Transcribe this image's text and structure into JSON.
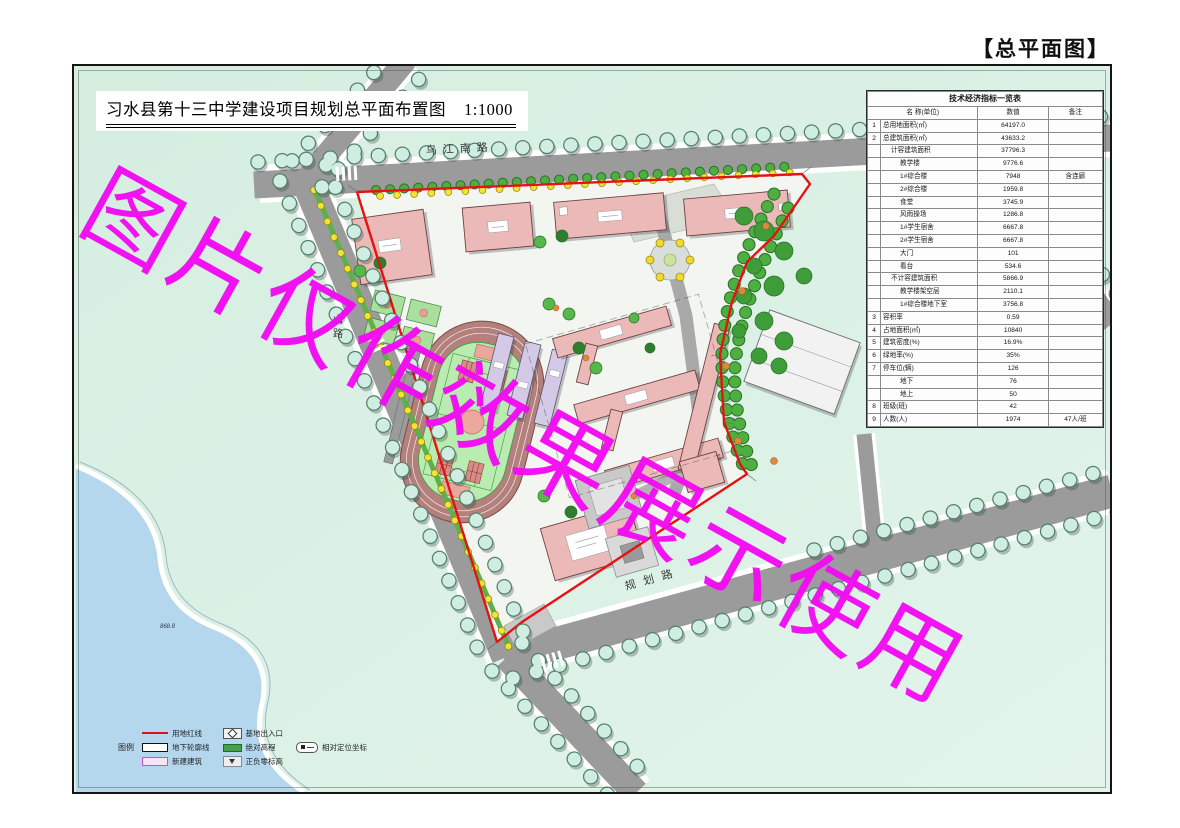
{
  "page_title": "【总平面图】",
  "drawing": {
    "title": "习水县第十三中学建设项目规划总平面布置图",
    "scale": "1:1000"
  },
  "watermark": "图片仅作效果展示使用",
  "roads": {
    "top": "乌江南路",
    "left": "山路",
    "bottom": "规划路"
  },
  "lake_label": "868.8",
  "indicator_table": {
    "title": "技术经济指标一览表",
    "headers": {
      "name": "名 称(单位)",
      "value": "数值",
      "remark": "备注"
    },
    "rows": [
      {
        "no": "1",
        "name": "总用地面积(㎡)",
        "indent": 0,
        "value": "64197.0",
        "remark": ""
      },
      {
        "no": "2",
        "name": "总建筑面积(㎡)",
        "indent": 0,
        "value": "43633.2",
        "remark": ""
      },
      {
        "no": "",
        "name": "计容建筑面积",
        "indent": 1,
        "value": "37796.3",
        "remark": ""
      },
      {
        "no": "",
        "name": "教学楼",
        "indent": 2,
        "value": "9776.6",
        "remark": ""
      },
      {
        "no": "",
        "name": "1#综合楼",
        "indent": 2,
        "value": "7948",
        "remark": "含连廊"
      },
      {
        "no": "",
        "name": "2#综合楼",
        "indent": 2,
        "value": "1959.8",
        "remark": ""
      },
      {
        "no": "",
        "name": "食堂",
        "indent": 2,
        "value": "3745.9",
        "remark": ""
      },
      {
        "no": "",
        "name": "风雨操场",
        "indent": 2,
        "value": "1286.8",
        "remark": ""
      },
      {
        "no": "",
        "name": "1#学生宿舍",
        "indent": 2,
        "value": "6667.8",
        "remark": ""
      },
      {
        "no": "",
        "name": "2#学生宿舍",
        "indent": 2,
        "value": "6667.8",
        "remark": ""
      },
      {
        "no": "",
        "name": "大门",
        "indent": 2,
        "value": "101",
        "remark": ""
      },
      {
        "no": "",
        "name": "看台",
        "indent": 2,
        "value": "534.6",
        "remark": ""
      },
      {
        "no": "",
        "name": "不计容建筑面积",
        "indent": 1,
        "value": "5866.9",
        "remark": ""
      },
      {
        "no": "",
        "name": "教学楼架空层",
        "indent": 2,
        "value": "2110.1",
        "remark": ""
      },
      {
        "no": "",
        "name": "1#综合楼地下室",
        "indent": 2,
        "value": "3756.8",
        "remark": ""
      },
      {
        "no": "3",
        "name": "容积率",
        "indent": 0,
        "value": "0.59",
        "remark": ""
      },
      {
        "no": "4",
        "name": "占地面积(㎡)",
        "indent": 0,
        "value": "10840",
        "remark": ""
      },
      {
        "no": "5",
        "name": "建筑密度(%)",
        "indent": 0,
        "value": "16.9%",
        "remark": ""
      },
      {
        "no": "6",
        "name": "绿地率(%)",
        "indent": 0,
        "value": "35%",
        "remark": ""
      },
      {
        "no": "7",
        "name": "停车位(辆)",
        "indent": 0,
        "value": "126",
        "remark": ""
      },
      {
        "no": "",
        "name": "地下",
        "indent": 2,
        "value": "76",
        "remark": ""
      },
      {
        "no": "",
        "name": "地上",
        "indent": 2,
        "value": "50",
        "remark": ""
      },
      {
        "no": "8",
        "name": "班级(班)",
        "indent": 0,
        "value": "42",
        "remark": ""
      },
      {
        "no": "9",
        "name": "人数(人)",
        "indent": 0,
        "value": "1974",
        "remark": "47人/班"
      }
    ]
  },
  "legend": {
    "label": "图例",
    "items": [
      {
        "symbol": "red-line",
        "label": "用地红线"
      },
      {
        "symbol": "underground-outline",
        "label": "地下轮廓线"
      },
      {
        "symbol": "new-building",
        "label": "新建建筑"
      },
      {
        "symbol": "site-entrance",
        "label": "基地出入口"
      },
      {
        "symbol": "absolute-elevation",
        "label": "绝对高程"
      },
      {
        "symbol": "zero-level",
        "label": "正负零标高"
      },
      {
        "symbol": "relative-coordinate",
        "label": "相对定位坐标"
      }
    ]
  },
  "colors": {
    "watermark": "#f30af3",
    "boundary_red": "#e51212",
    "building_pink": "#ecb9b9",
    "road_gray": "#9b9b9b",
    "tree_teal": "#cfeee1",
    "field_green": "#baecb2",
    "lake_blue": "#b5d7ee"
  }
}
